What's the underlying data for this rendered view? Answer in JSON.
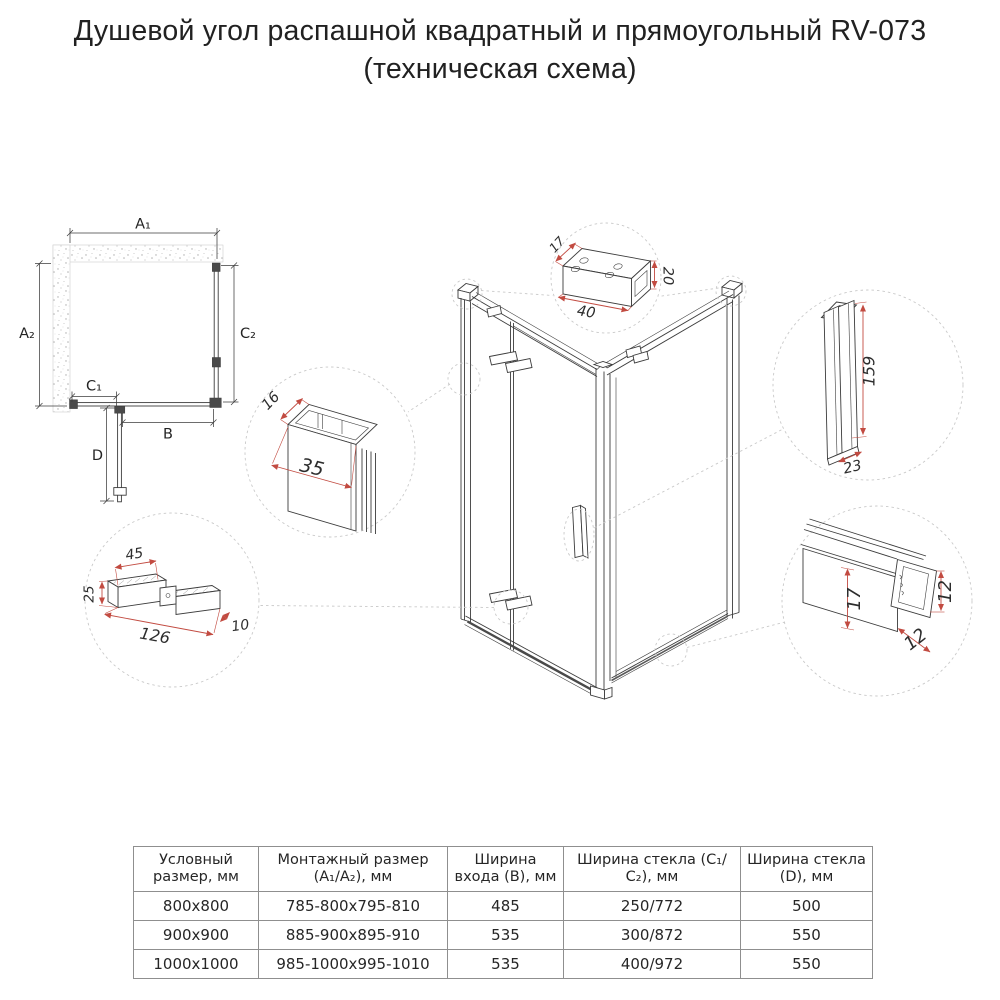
{
  "title": {
    "line1": "Душевой угол распашной квадратный и прямоугольный RV-073",
    "line2": "(техническая схема)"
  },
  "plan": {
    "dims": {
      "a1": "A₁",
      "a2": "A₂",
      "c2": "C₂",
      "c1": "C₁",
      "b": "B",
      "d": "D"
    }
  },
  "details": {
    "top_bracket": {
      "depth": "17",
      "width": "40",
      "height": "20"
    },
    "wall_profile": {
      "depth": "16",
      "face_width": "35"
    },
    "hinge": {
      "plate_top": "45",
      "plate_side": "25",
      "length": "126",
      "thickness": "10"
    },
    "handle": {
      "height": "159",
      "depth": "23"
    },
    "bottom_profile": {
      "inner_height": "17",
      "outer_height": "12",
      "depth": "12"
    }
  },
  "table": {
    "headers": [
      "Условный размер, мм",
      "Монтажный размер (А₁/А₂), мм",
      "Ширина входа (B), мм",
      "Ширина стекла (С₁/С₂), мм",
      "Ширина стекла (D), мм"
    ],
    "rows": [
      [
        "800x800",
        "785-800x795-810",
        "485",
        "250/772",
        "500"
      ],
      [
        "900x900",
        "885-900x895-910",
        "535",
        "300/872",
        "550"
      ],
      [
        "1000x1000",
        "985-1000x995-1010",
        "535",
        "400/972",
        "550"
      ]
    ]
  },
  "colors": {
    "line": "#3c3c3c",
    "dimension_red": "#c24b41",
    "dashed_gray": "#c9c9c9",
    "text": "#242424",
    "table_border": "#8f8f8f",
    "background": "#ffffff"
  }
}
